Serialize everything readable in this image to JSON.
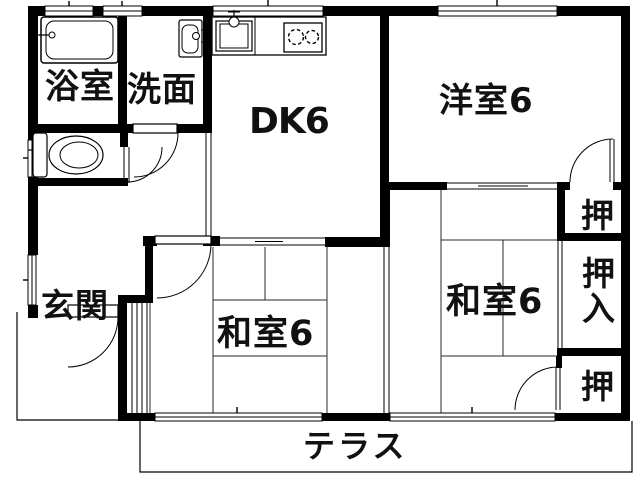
{
  "rooms": {
    "bathroom": {
      "label": "浴室"
    },
    "washroom": {
      "label": "洗面"
    },
    "dining_kitchen": {
      "label": "DK6"
    },
    "western_room": {
      "label": "洋室6"
    },
    "japanese_room_right": {
      "label": "和室6"
    },
    "japanese_room_left": {
      "label": "和室6"
    },
    "entrance": {
      "label": "玄関"
    },
    "terrace": {
      "label": "テラス"
    },
    "closet_upper": {
      "label": "押"
    },
    "closet_oshiire": {
      "label": "押入"
    },
    "closet_lower": {
      "label": "押"
    }
  },
  "colors": {
    "walls": "#000000",
    "background": "#ffffff",
    "text": "#111111"
  }
}
